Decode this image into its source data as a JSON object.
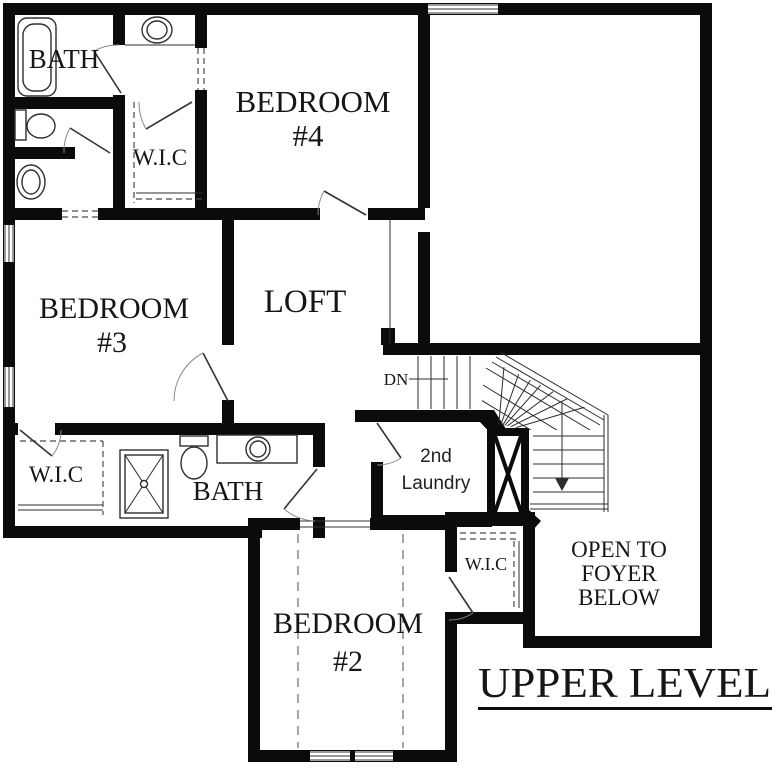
{
  "colors": {
    "wall": "#0b0b0b",
    "thin_line": "#2e2e2e",
    "background": "#ffffff",
    "label": "#161616"
  },
  "title": {
    "text": "UPPER LEVEL"
  },
  "rooms": {
    "bath_upper": {
      "label": "BATH"
    },
    "wic_upper": {
      "label": "W.I.C"
    },
    "bedroom4": {
      "line1": "BEDROOM",
      "line2": "#4"
    },
    "bedroom3": {
      "line1": "BEDROOM",
      "line2": "#3"
    },
    "loft": {
      "label": "LOFT"
    },
    "wic_left": {
      "label": "W.I.C"
    },
    "bath_lower": {
      "label": "BATH"
    },
    "laundry": {
      "line1": "2nd",
      "line2": "Laundry"
    },
    "wic_bedroom2": {
      "label": "W.I.C"
    },
    "bedroom2": {
      "line1": "BEDROOM",
      "line2": "#2"
    },
    "foyer": {
      "line1": "OPEN TO",
      "line2": "FOYER",
      "line3": "BELOW"
    }
  },
  "stairs": {
    "down_label": "DN"
  },
  "fixtures": [
    "bathtub-icon",
    "vanity-sink-icon",
    "toilet-icon",
    "laundry-sink-icon",
    "shower-icon",
    "toilet-icon",
    "vanity-sink-icon",
    "stair-shaft-icon"
  ]
}
